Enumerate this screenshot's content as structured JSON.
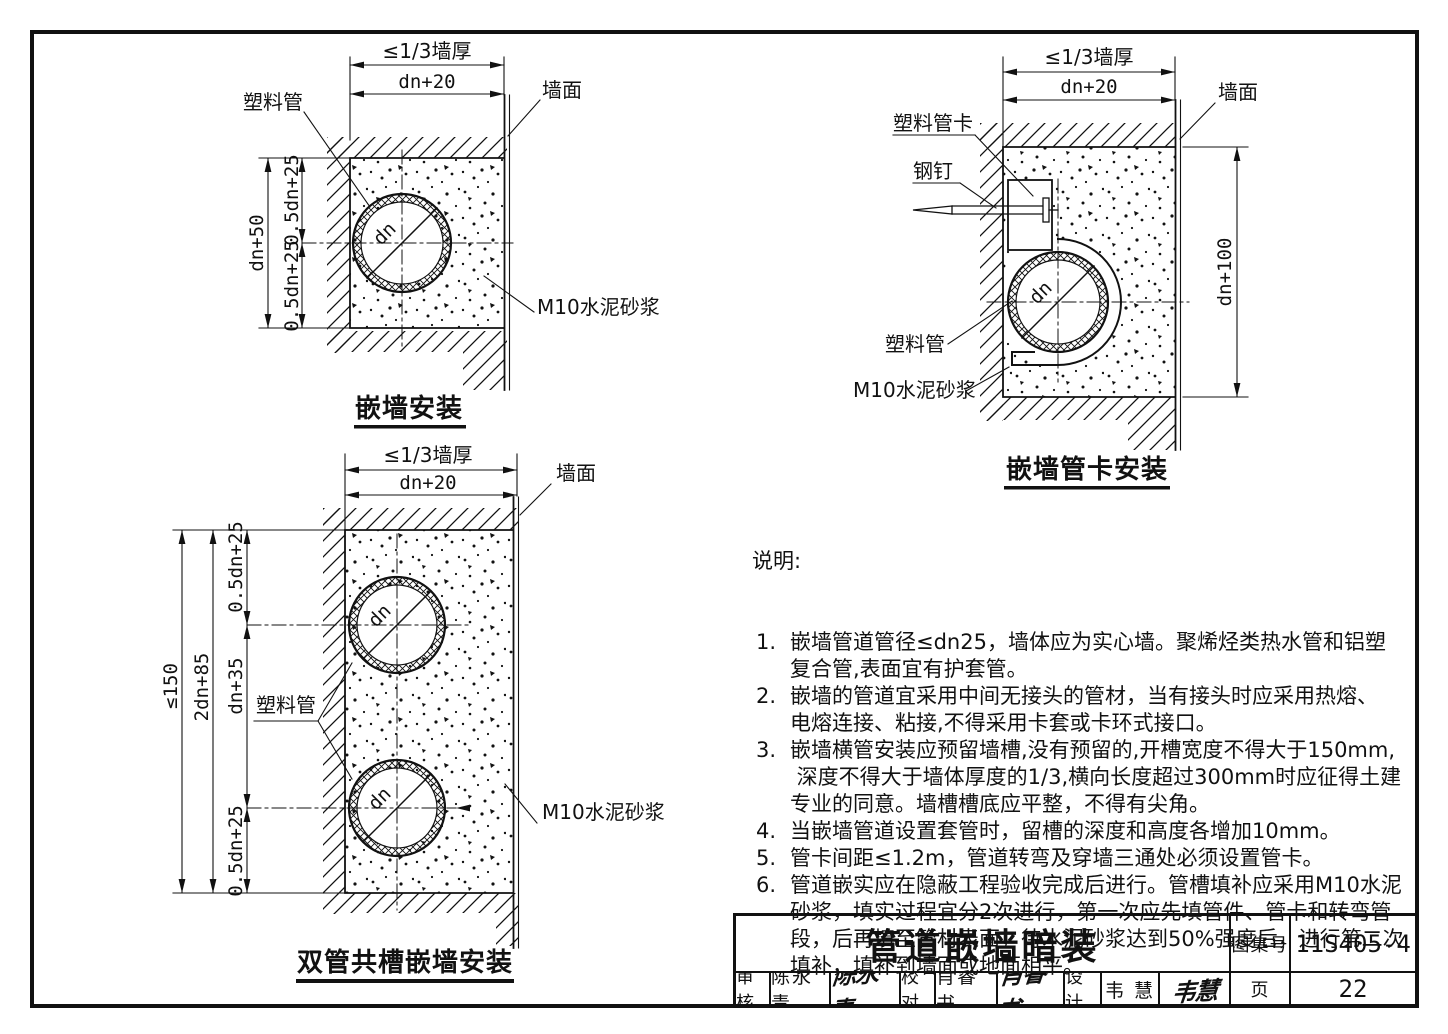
{
  "colors": {
    "ink": "#111111",
    "paper": "#ffffff"
  },
  "d1": {
    "title": "嵌墙安装",
    "t_thick": "≤1/3墙厚",
    "t_w": "dn+20",
    "l_pipe": "塑料管",
    "l_face": "墙面",
    "l_mortar": "M10水泥砂浆",
    "dim_h": "dn+50",
    "dim_half_t": "0.5dn+25",
    "dim_half_b": "0.5dn+25",
    "dn": "dn"
  },
  "d2": {
    "title": "嵌墙管卡安装",
    "t_thick": "≤1/3墙厚",
    "t_w": "dn+20",
    "l_clamp": "塑料管卡",
    "l_nail": "钢钉",
    "l_pipe": "塑料管",
    "l_face": "墙面",
    "l_mortar": "M10水泥砂浆",
    "dim_h": "dn+100",
    "dn": "dn"
  },
  "d3": {
    "title": "双管共槽嵌墙安装",
    "t_thick": "≤1/3墙厚",
    "t_w": "dn+20",
    "l_pipe": "塑料管",
    "l_face": "墙面",
    "l_mortar": "M10水泥砂浆",
    "dim_total": "≤150",
    "dim_2dn": "2dn+85",
    "dim_a": "0.5dn+25",
    "dim_b": "dn+35",
    "dim_c": "0.5dn+25",
    "dn1": "dn",
    "dn2": "dn"
  },
  "notes": {
    "heading": "说明:",
    "rows": [
      {
        "n": "1.",
        "t": "嵌墙管道管径≤dn25，墙体应为实心墙。聚烯烃类热水管和铝塑"
      },
      {
        "n": "",
        "t": "复合管,表面宜有护套管。"
      },
      {
        "n": "2.",
        "t": "嵌墙的管道宜采用中间无接头的管材，当有接头时应采用热熔、"
      },
      {
        "n": "",
        "t": "电熔连接、粘接,不得采用卡套或卡环式接口。"
      },
      {
        "n": "3.",
        "t": "嵌墙横管安装应预留墙槽,没有预留的,开槽宽度不得大于150mm,"
      },
      {
        "n": "",
        "t": " 深度不得大于墙体厚度的1/3,横向长度超过300mm时应征得土建"
      },
      {
        "n": "",
        "t": "专业的同意。墙槽槽底应平整，不得有尖角。"
      },
      {
        "n": "4.",
        "t": "当嵌墙管道设置套管时，留槽的深度和高度各增加10mm。"
      },
      {
        "n": "5.",
        "t": "管卡间距≤1.2m，管道转弯及穿墙三通处必须设置管卡。"
      },
      {
        "n": "6.",
        "t": "管道嵌实应在隐蔽工程验收完成后进行。管槽填补应采用M10水泥"
      },
      {
        "n": "",
        "t": "砂浆，填实过程宜分2次进行，第一次应先填管件、管卡和转弯管"
      },
      {
        "n": "",
        "t": "段，后再填至管材表面，待水泥砂浆达到50%强度后，进行第二次"
      },
      {
        "n": "",
        "t": "填补，填补到墙面或地面相平。"
      }
    ]
  },
  "titleblock": {
    "title": "管道嵌墙暗装",
    "atlas_label": "图集号",
    "atlas_no": "11S405-4",
    "page_label": "页",
    "page_no": "22",
    "review_label": "审核",
    "review_name": "陈永青",
    "review_sig": "陈永青",
    "proof_label": "校对",
    "proof_name": "肖睿书",
    "proof_sig": "肖睿书",
    "design_label": "设计",
    "design_name": "韦 慧",
    "design_sig": "韦慧"
  }
}
